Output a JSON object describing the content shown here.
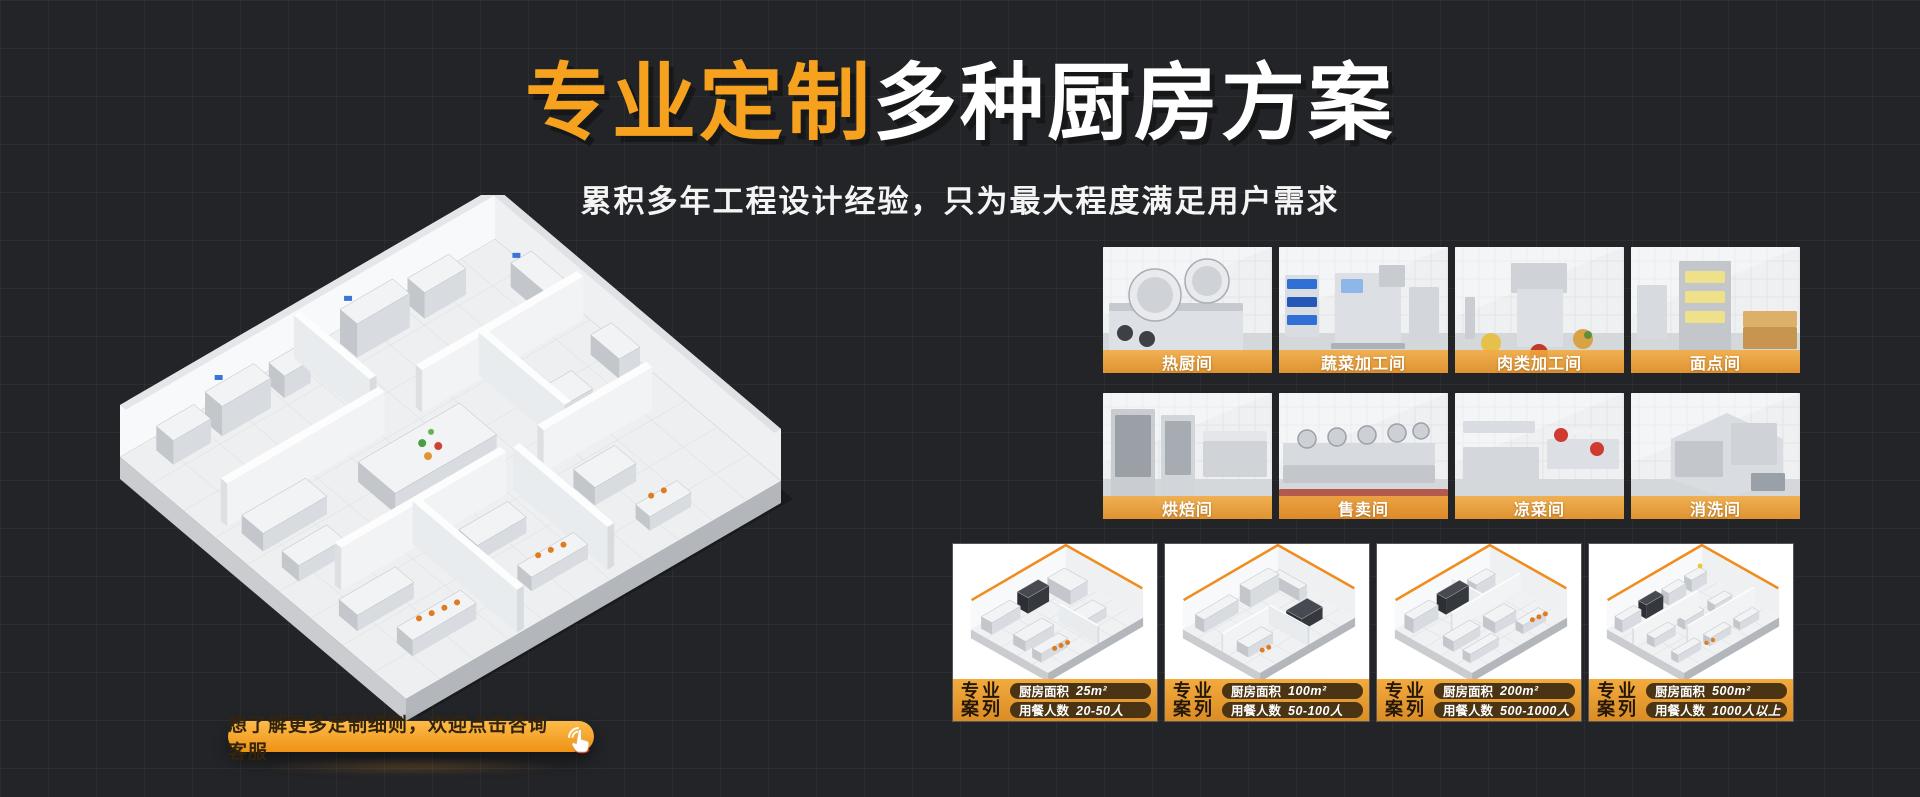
{
  "hero": {
    "title_highlight": "专业定制",
    "title_rest": "多种厨房方案",
    "subtitle": "累积多年工程设计经验，只为最大程度满足用户需求"
  },
  "rooms": [
    {
      "label": "热厨间"
    },
    {
      "label": "蔬菜加工间"
    },
    {
      "label": "肉类加工间"
    },
    {
      "label": "面点间"
    },
    {
      "label": "烘焙间"
    },
    {
      "label": "售卖间"
    },
    {
      "label": "凉菜间"
    },
    {
      "label": "消洗间"
    }
  ],
  "cases": [
    {
      "tag_line1": "专业",
      "tag_line2": "案列",
      "area_label": "厨房面积",
      "area_value": "25m²",
      "diners_label": "用餐人数",
      "diners_value": "20-50人"
    },
    {
      "tag_line1": "专业",
      "tag_line2": "案列",
      "area_label": "厨房面积",
      "area_value": "100m²",
      "diners_label": "用餐人数",
      "diners_value": "50-100人"
    },
    {
      "tag_line1": "专业",
      "tag_line2": "案列",
      "area_label": "厨房面积",
      "area_value": "200m²",
      "diners_label": "用餐人数",
      "diners_value": "500-1000人"
    },
    {
      "tag_line1": "专业",
      "tag_line2": "案列",
      "area_label": "厨房面积",
      "area_value": "500m²",
      "diners_label": "用餐人数",
      "diners_value": "1000人以上"
    }
  ],
  "cta": {
    "label": "想了解更多定制细则，欢迎点击咨询客服",
    "icon": "hand-click-icon"
  },
  "colors": {
    "accent_orange": "#F7A21E",
    "band_orange": "#EDA03A",
    "pill_brown": "#4A3413",
    "page_bg": "#232427"
  }
}
